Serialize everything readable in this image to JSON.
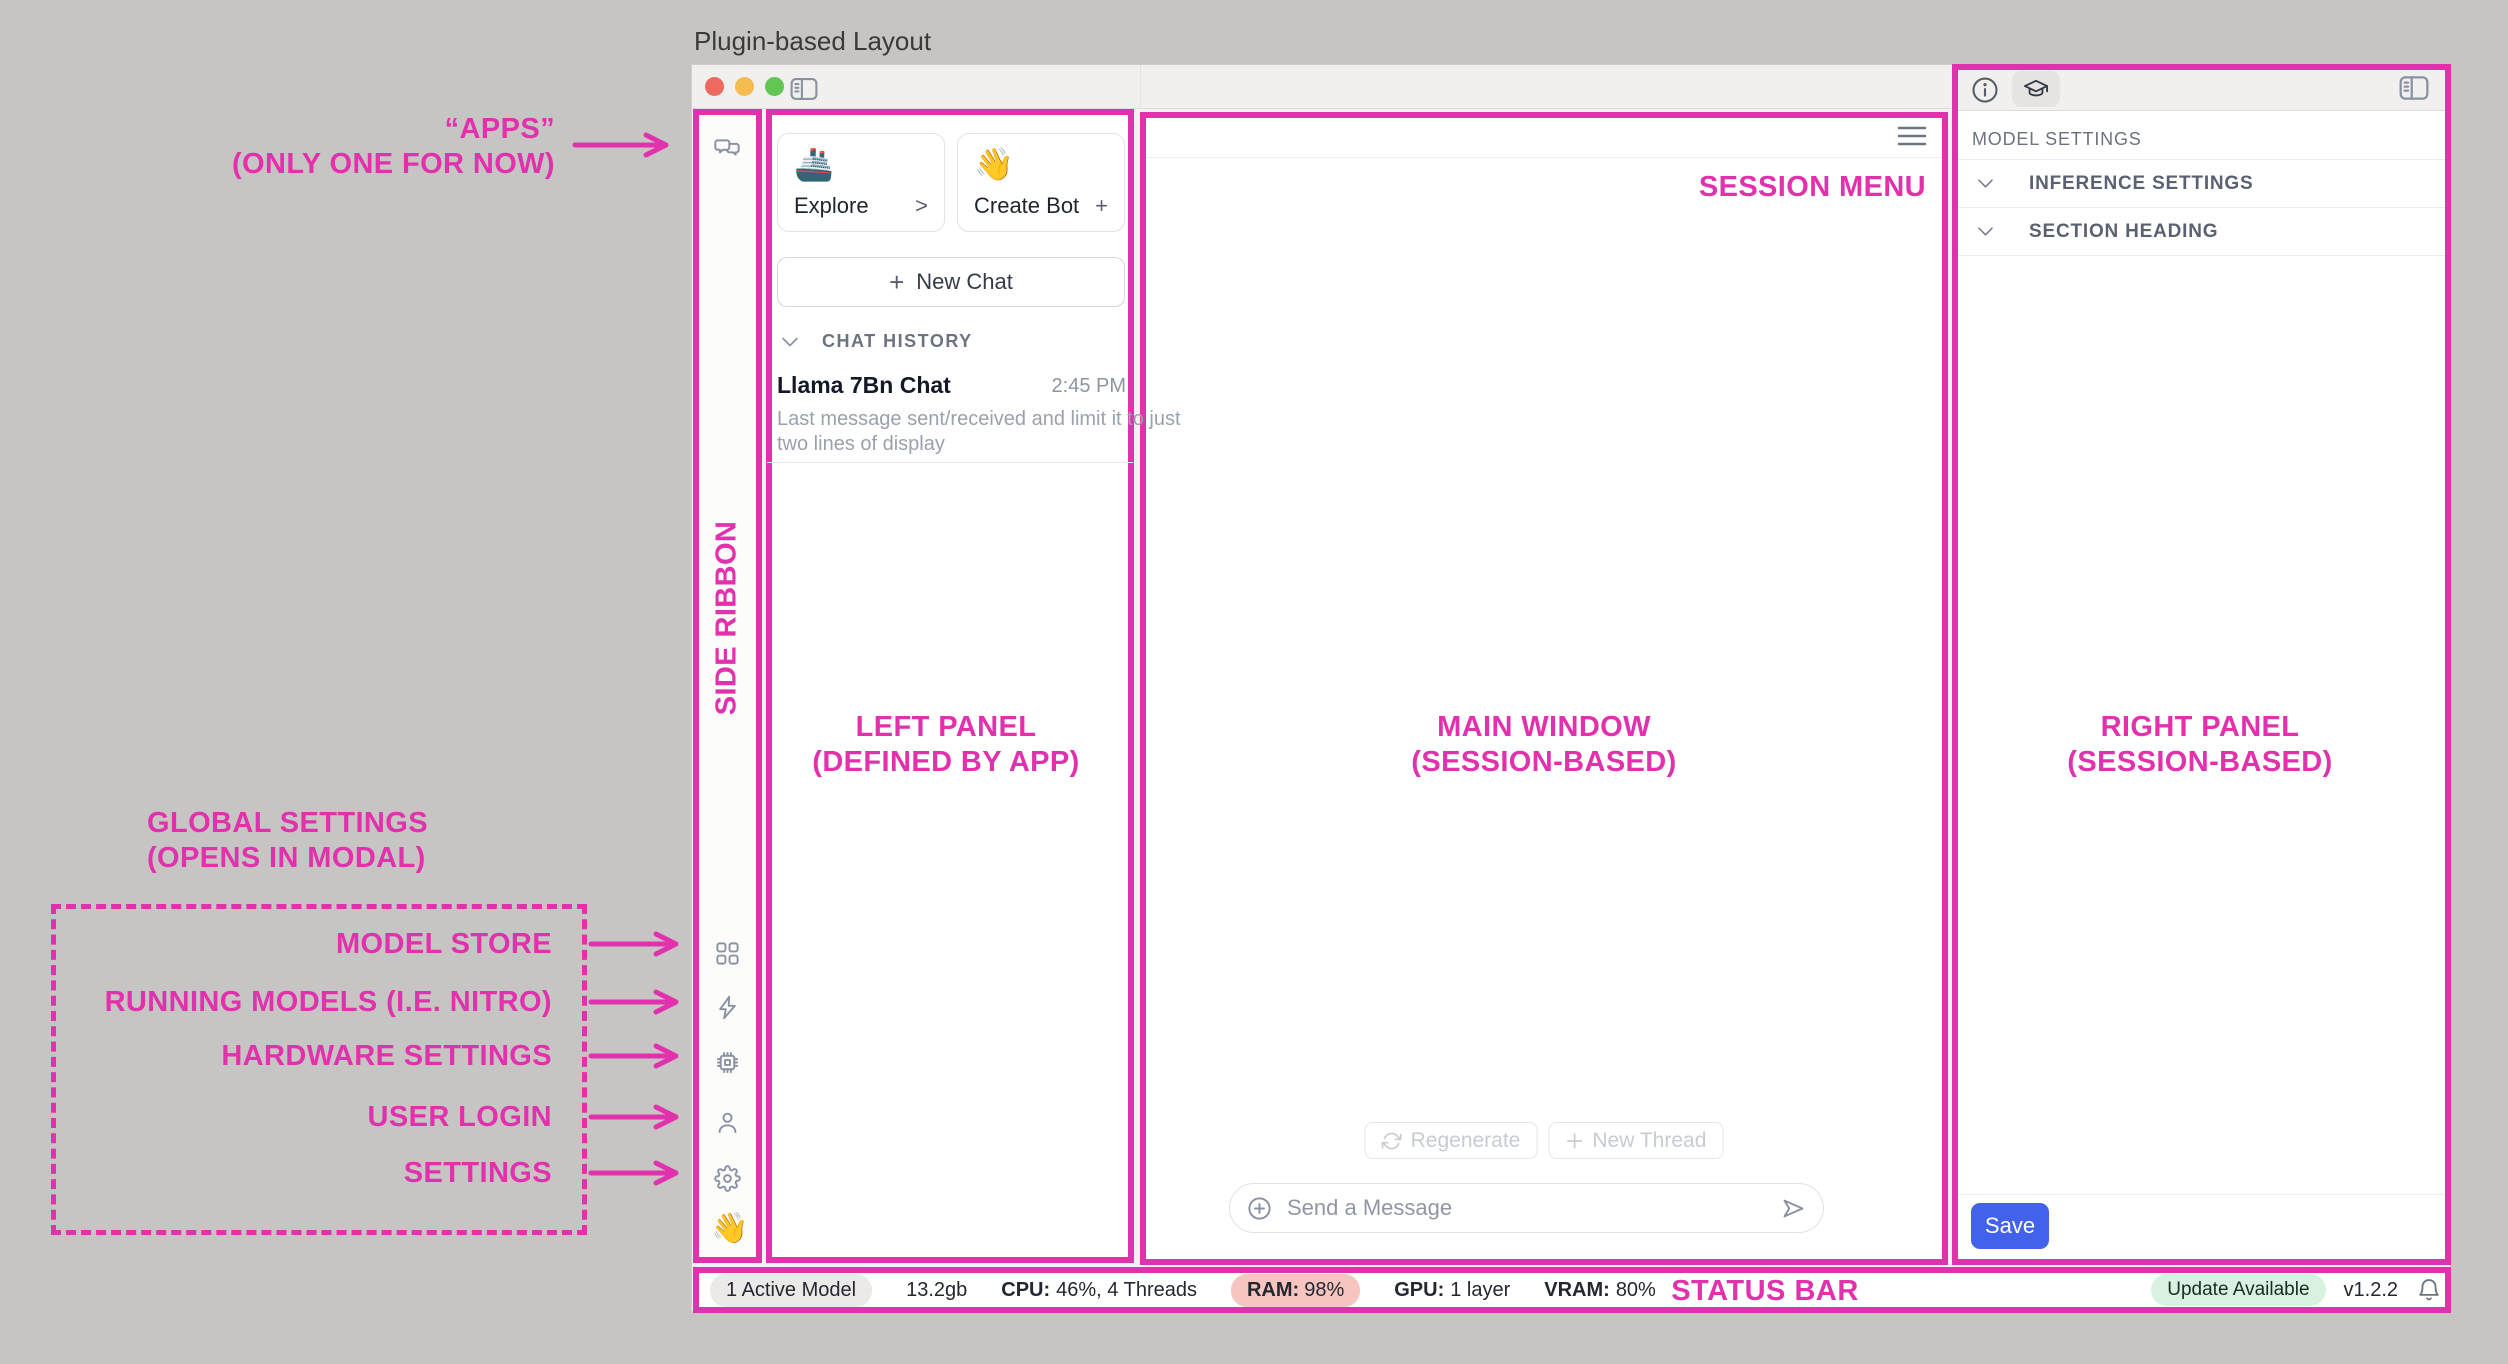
{
  "colors": {
    "magenta": "#E231AC",
    "save_button_blue": "#4262EB",
    "ram_badge_bg": "#F6C5C0",
    "update_badge_bg": "#D9F1E1",
    "active_model_badge_bg": "#ECEAE8",
    "traffic_red": "#EE6A5F",
    "traffic_yellow": "#F5BD4F",
    "traffic_green": "#62C554"
  },
  "page": {
    "title": "Plugin-based Layout"
  },
  "annotations": {
    "apps_line1": "“APPS”",
    "apps_line2": "(ONLY ONE FOR NOW)",
    "side_ribbon": "SIDE RIBBON",
    "left_panel_line1": "LEFT PANEL",
    "left_panel_line2": "(DEFINED BY APP)",
    "main_window_line1": "MAIN WINDOW",
    "main_window_line2": "(SESSION-BASED)",
    "right_panel_line1": "RIGHT PANEL",
    "right_panel_line2": "(SESSION-BASED)",
    "session_menu": "SESSION MENU",
    "status_bar": "STATUS BAR",
    "global_settings_line1": "GLOBAL SETTINGS",
    "global_settings_line2": "(OPENS IN MODAL)",
    "ribbon_items": [
      "MODEL STORE",
      "RUNNING MODELS (I.E. NITRO)",
      "HARDWARE SETTINGS",
      "USER LOGIN",
      "SETTINGS"
    ]
  },
  "ribbon": {
    "wave_emoji": "👋"
  },
  "left_panel": {
    "cards": [
      {
        "emoji": "🚢",
        "label": "Explore",
        "action": ">"
      },
      {
        "emoji": "👋",
        "label": "Create Bot",
        "action": "+"
      }
    ],
    "new_chat_plus": "+",
    "new_chat_label": "New Chat",
    "history_header": "CHAT HISTORY",
    "chat_item": {
      "title": "Llama 7Bn Chat",
      "time": "2:45 PM",
      "preview_line1": "Last message sent/received and limit it to just",
      "preview_line2": "two lines of display"
    }
  },
  "main": {
    "regenerate_label": "Regenerate",
    "new_thread_label": "New Thread",
    "input_placeholder": "Send a Message"
  },
  "right_panel": {
    "section_title": "MODEL SETTINGS",
    "rows": [
      "INFERENCE SETTINGS",
      "SECTION HEADING"
    ],
    "save_label": "Save"
  },
  "status_bar": {
    "active_models": "1 Active Model",
    "memory": "13.2gb",
    "cpu_label": "CPU:",
    "cpu_value": "46%, 4 Threads",
    "ram_label": "RAM:",
    "ram_value": "98%",
    "gpu_label": "GPU:",
    "gpu_value": "1 layer",
    "vram_label": "VRAM:",
    "vram_value": "80%",
    "update_badge": "Update Available",
    "version": "v1.2.2"
  }
}
